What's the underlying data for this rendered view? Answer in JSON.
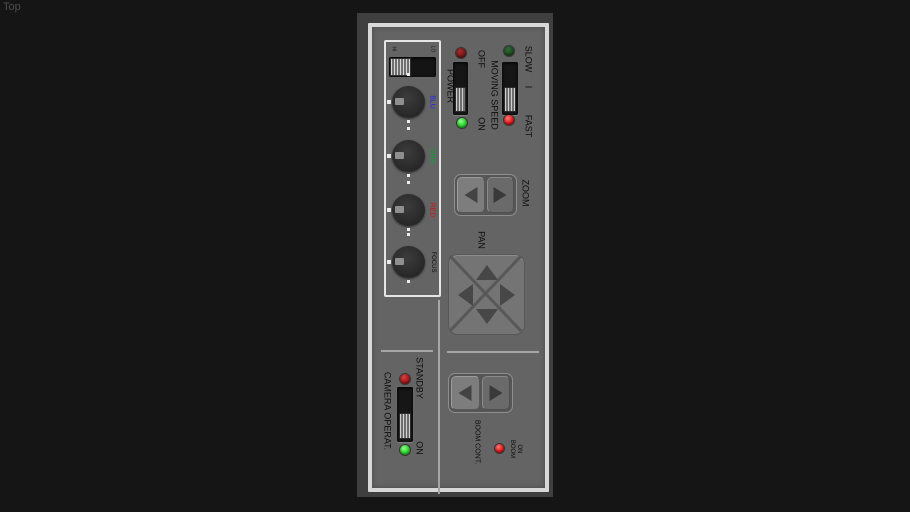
{
  "viewport": {
    "view_label": "Top"
  },
  "panel": {
    "ccu": {
      "slider": {
        "left_mark": "HI",
        "right_mark": "LO"
      },
      "knobs": [
        {
          "label": "BLU"
        },
        {
          "label": "GRN"
        },
        {
          "label": "RED"
        },
        {
          "label": "FOCUS"
        }
      ]
    },
    "power": {
      "label": "POWER",
      "top_label": "OFF",
      "bottom_label": "ON",
      "selected": "ON"
    },
    "speed": {
      "label": "MOVING SPEED",
      "top_label": "SLOW",
      "mid_label": "I",
      "bottom_label": "FAST",
      "selected": "FAST"
    },
    "zoom": {
      "label": "ZOOM"
    },
    "pan": {
      "label": "PAN"
    },
    "camera": {
      "label": "CAMERA OPERAT.",
      "top_label": "STANDBY",
      "bottom_label": "ON",
      "selected": "ON"
    },
    "boom": {
      "label": "BOOM CONT.",
      "led_word_1": "BOOM",
      "led_word_2": "ON"
    }
  },
  "colors": {
    "led_green_on": "#2bd32b",
    "led_green_dim": "#1d4a1f",
    "led_red_on": "#e21818",
    "led_red_dim": "#7a1414",
    "led_red_standby": "#a81414",
    "knob_label_blue": "#2323e8",
    "knob_label_green": "#00a830",
    "knob_label_red": "#d01212",
    "panel_gray": "#646464",
    "frame_white": "#d8d8d8"
  }
}
